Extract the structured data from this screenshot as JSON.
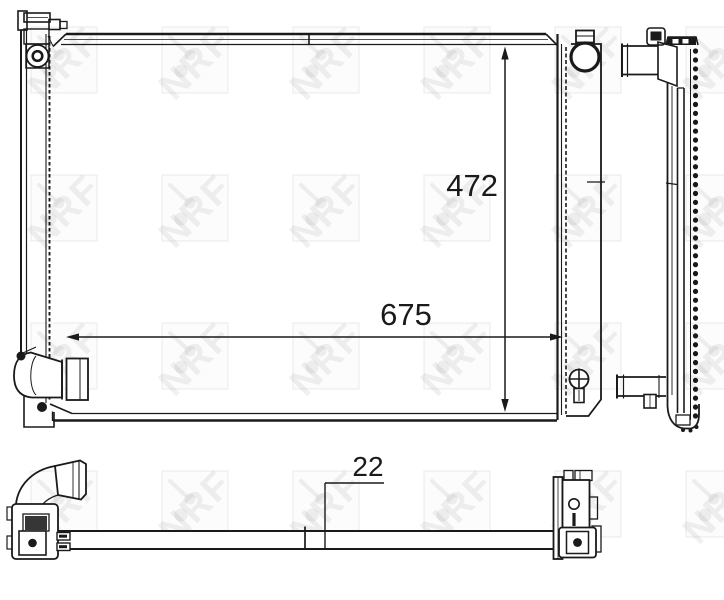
{
  "watermark": {
    "text": "NRF",
    "color": "rgba(0,0,0,0.06)"
  },
  "drawing": {
    "line_color": "#1a1a1a",
    "background_color": "#ffffff"
  },
  "dimensions": {
    "core_height": {
      "value": "472"
    },
    "core_width": {
      "value": "675"
    },
    "core_depth": {
      "value": "22"
    }
  }
}
